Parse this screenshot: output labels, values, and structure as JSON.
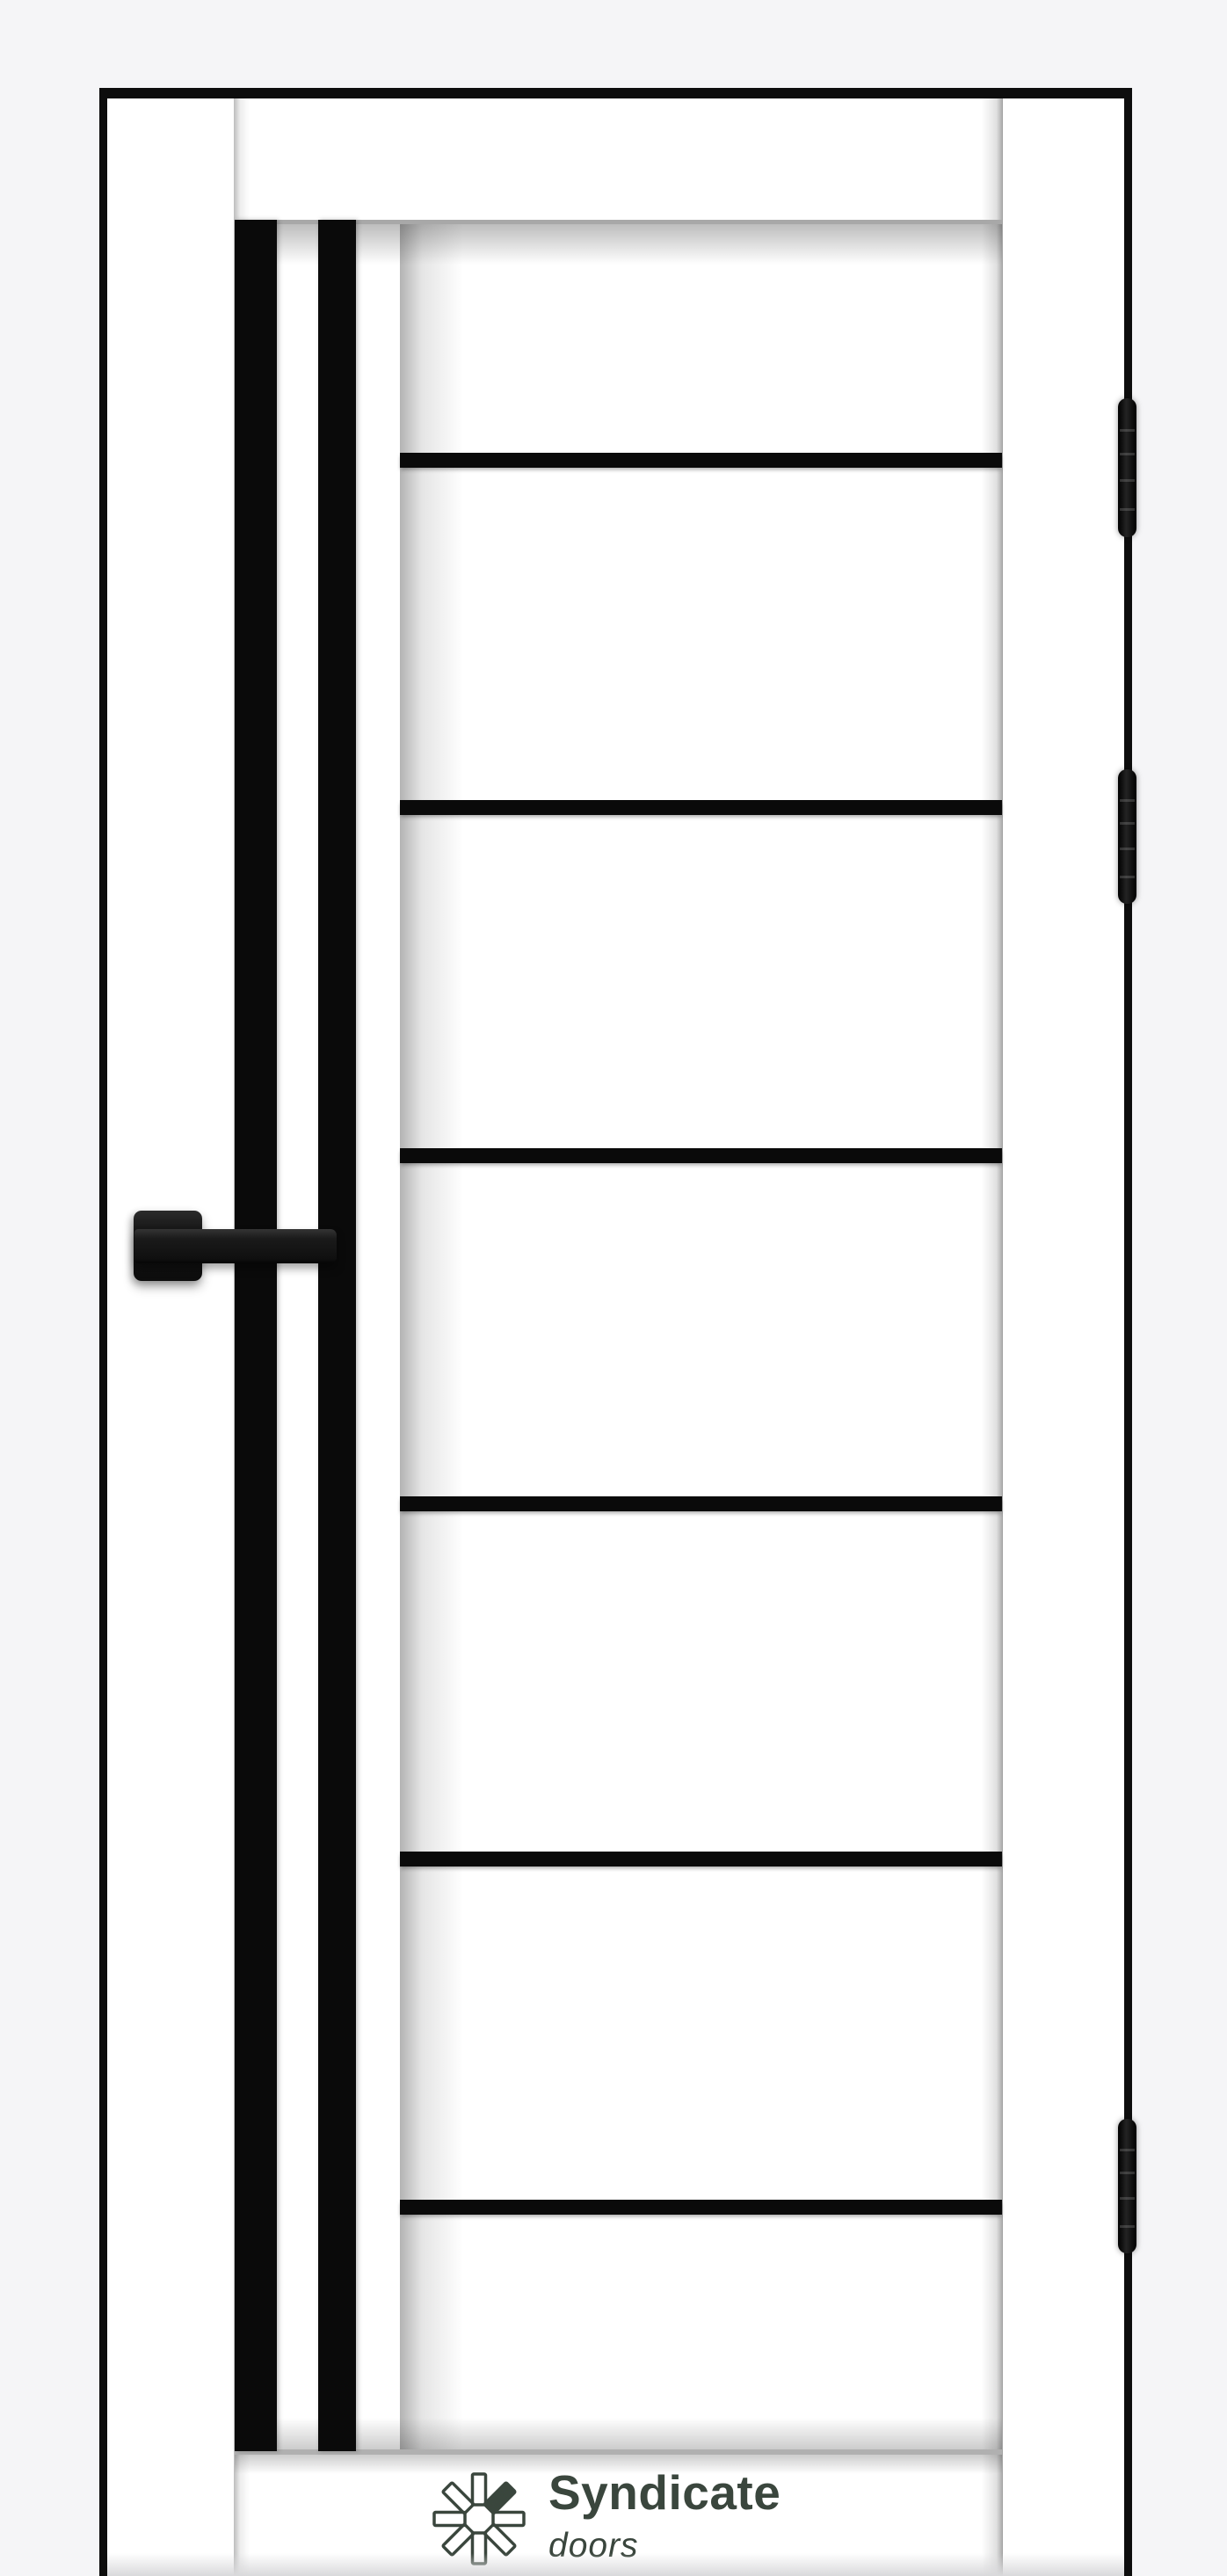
{
  "brand": {
    "name": "Syndicate",
    "tagline": "doors",
    "icon": "pinwheel-logo-icon"
  },
  "door": {
    "leaf_finish": "white",
    "insert_finish": "black glass",
    "vertical_insert_count": 2,
    "horizontal_insert_count": 6,
    "hinge_count": 3,
    "hardware": "black square-rosette lever handle"
  },
  "colors": {
    "background": "#f5f5f7",
    "frame": "#0d0d0d",
    "leaf": "#ffffff",
    "insert": "#0a0a0a",
    "brand": "#3a463d",
    "hardware": "#151515"
  }
}
